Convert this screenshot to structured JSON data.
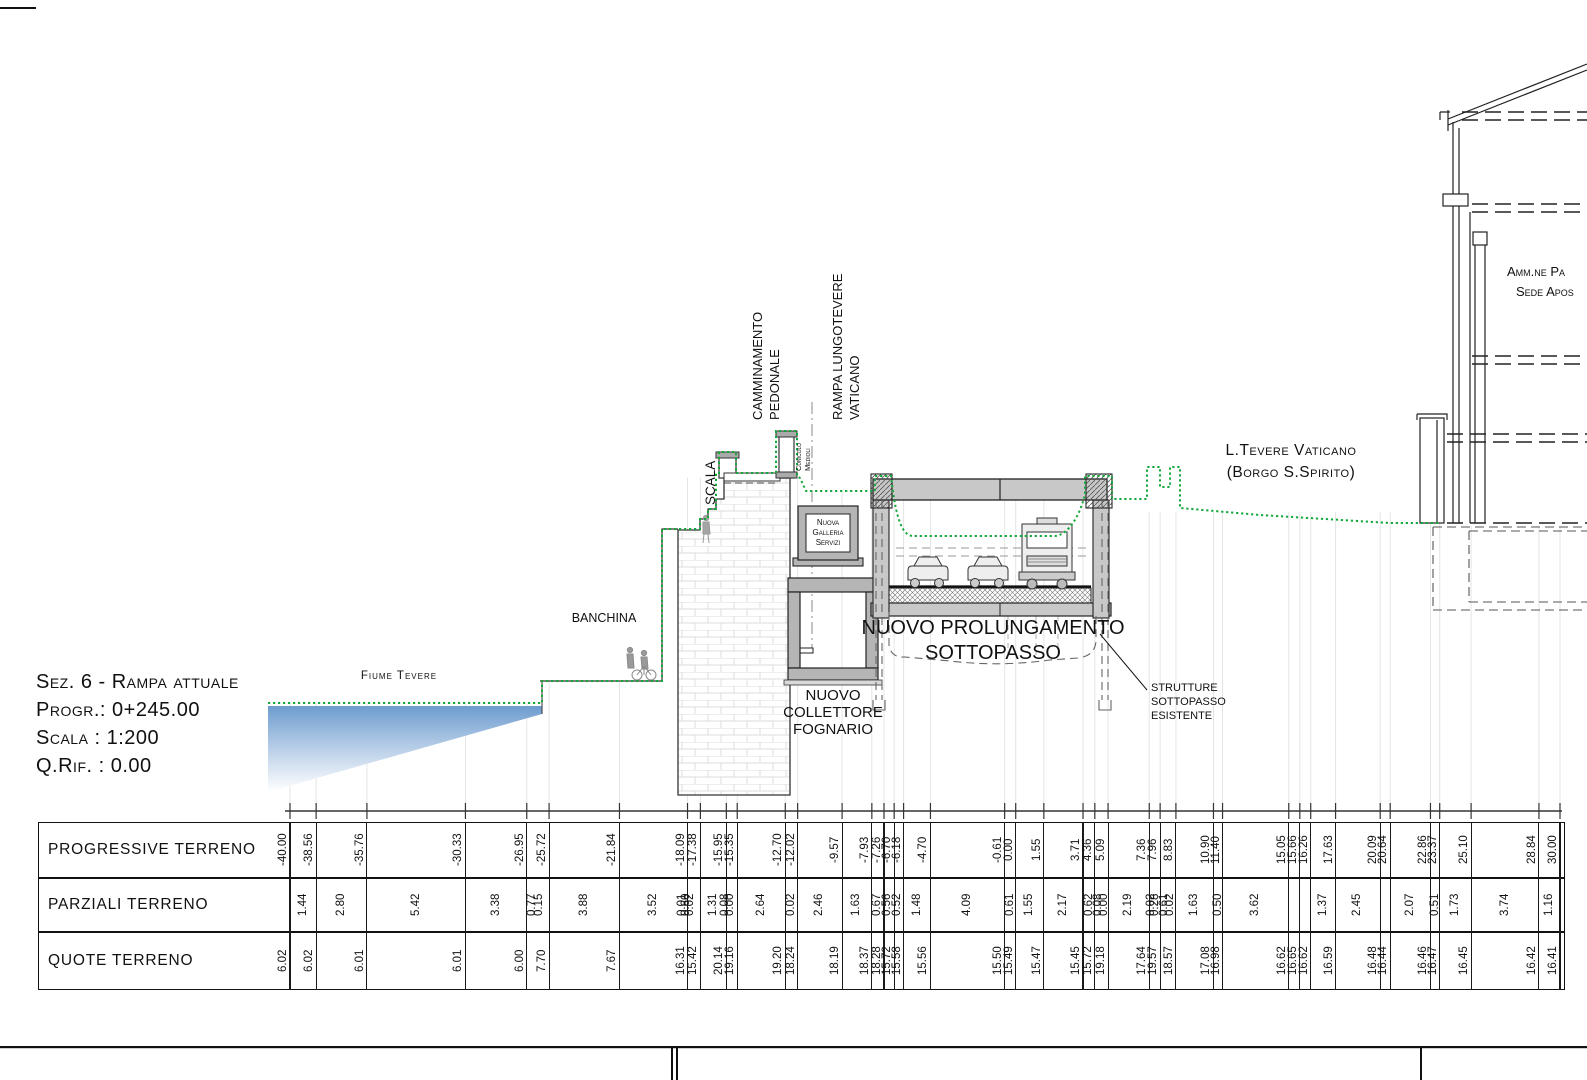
{
  "section_info": {
    "title": "Sez. 6 - Rampa attuale",
    "progressiva": "Progr.: 0+245.00",
    "scala": "Scala : 1:200",
    "q_rif": "Q.Rif. : 0.00"
  },
  "drawing_labels": {
    "fiume_tevere": "Fiume Tevere",
    "banchina": "BANCHINA",
    "scala": "SCALA",
    "camminamento_1": "CAMMINAMENTO",
    "camminamento_2": "PEDONALE",
    "rampa_1": "RAMPA LUNGOTEVERE",
    "rampa_2": "VATICANO",
    "cunicolo_1": "Cunicolo",
    "cunicolo_2": "Medioli",
    "galleria_1": "Nuova",
    "galleria_2": "Galleria",
    "galleria_3": "Servizi",
    "collettore_1": "NUOVO",
    "collettore_2": "COLLETTORE",
    "collettore_3": "FOGNARIO",
    "prolungamento_1": "NUOVO PROLUNGAMENTO",
    "prolungamento_2": "SOTTOPASSO",
    "strutture_1": "STRUTTURE",
    "strutture_2": "SOTTOPASSO",
    "strutture_3": "ESISTENTE",
    "lungotevere_1": "L.Tevere Vaticano",
    "lungotevere_2": "(Borgo S.Spirito)",
    "edificio_1": "Amm.ne Pa",
    "edificio_2": "Sede Apos"
  },
  "colors": {
    "terrain_green": "#14a83b",
    "water_blue": "#6d9ccf",
    "concrete_gray": "#b5b5b5"
  },
  "table": {
    "row_labels": [
      "PROGRESSIVE TERRENO",
      "PARZIALI TERRENO",
      "QUOTE TERRENO"
    ],
    "stations": [
      {
        "v": -40.0,
        "progressive": "-40.00",
        "quote": "6.02"
      },
      {
        "v": -38.56,
        "progressive": "-38.56",
        "quote": "6.02"
      },
      {
        "v": -35.76,
        "progressive": "-35.76",
        "quote": "6.01"
      },
      {
        "v": -30.33,
        "progressive": "-30.33",
        "quote": "6.01"
      },
      {
        "v": -26.95,
        "progressive": "-26.95",
        "quote": "6.00"
      },
      {
        "v": -25.72,
        "progressive": "-25.72",
        "quote": "7.70"
      },
      {
        "v": -21.84,
        "progressive": "-21.84",
        "quote": "7.67"
      },
      {
        "v": -18.09,
        "progressive": "-18.09",
        "quote": "16.31"
      },
      {
        "v": -17.38,
        "progressive": "-17.38",
        "quote": "15.42"
      },
      {
        "v": -15.95,
        "progressive": "-15.95",
        "quote": "20.14"
      },
      {
        "v": -15.35,
        "progressive": "-15.35",
        "quote": "19.16"
      },
      {
        "v": -12.7,
        "progressive": "-12.70",
        "quote": "19.20"
      },
      {
        "v": -12.02,
        "progressive": "-12.02",
        "quote": "18.24"
      },
      {
        "v": -9.57,
        "progressive": "-9.57",
        "quote": "18.19"
      },
      {
        "v": -7.93,
        "progressive": "-7.93",
        "quote": "18.37"
      },
      {
        "v": -7.26,
        "progressive": "-7.26",
        "quote": "18.28"
      },
      {
        "v": -6.7,
        "progressive": "-6.70",
        "quote": "15.72"
      },
      {
        "v": -6.18,
        "progressive": "-6.18",
        "quote": "15.58"
      },
      {
        "v": -4.7,
        "progressive": "-4.70",
        "quote": "15.56"
      },
      {
        "v": -0.61,
        "progressive": "-0.61",
        "quote": "15.50"
      },
      {
        "v": 0.0,
        "progressive": "0.00",
        "quote": "15.49"
      },
      {
        "v": 1.55,
        "progressive": "1.55",
        "quote": "15.47"
      },
      {
        "v": 3.71,
        "progressive": "3.71",
        "quote": "15.45"
      },
      {
        "v": 4.36,
        "progressive": "4.36",
        "quote": "15.72"
      },
      {
        "v": 5.09,
        "progressive": "5.09",
        "quote": "19.18"
      },
      {
        "v": 7.36,
        "progressive": "7.36",
        "quote": "17.64"
      },
      {
        "v": 7.96,
        "progressive": "7.96",
        "quote": "19.57"
      },
      {
        "v": 8.83,
        "progressive": "8.83",
        "quote": "18.57"
      },
      {
        "v": 10.9,
        "progressive": "10.90",
        "quote": "17.08"
      },
      {
        "v": 11.4,
        "progressive": "11.40",
        "quote": "16.98"
      },
      {
        "v": 15.05,
        "progressive": "15.05",
        "quote": "16.62"
      },
      {
        "v": 15.66,
        "progressive": "15.66",
        "quote": "16.65"
      },
      {
        "v": 16.26,
        "progressive": "16.26",
        "quote": "16.62"
      },
      {
        "v": 17.63,
        "progressive": "17.63",
        "quote": "16.59"
      },
      {
        "v": 20.09,
        "progressive": "20.09",
        "quote": "16.48"
      },
      {
        "v": 20.64,
        "progressive": "20.64",
        "quote": "16.44"
      },
      {
        "v": 22.86,
        "progressive": "22.86",
        "quote": "16.46"
      },
      {
        "v": 23.37,
        "progressive": "23.37",
        "quote": "16.47"
      },
      {
        "v": 25.1,
        "progressive": "25.10",
        "quote": "16.45"
      },
      {
        "v": 28.84,
        "progressive": "28.84",
        "quote": "16.42"
      },
      {
        "v": 30.0,
        "progressive": "30.00",
        "quote": "16.41"
      }
    ],
    "parziali": [
      {
        "value": "1.44",
        "pos": -39.28
      },
      {
        "value": "2.80",
        "pos": -37.16
      },
      {
        "value": "5.42",
        "pos": -33.05
      },
      {
        "value": "3.38",
        "pos": -28.64
      },
      {
        "value": "0.77",
        "pos": -26.62
      },
      {
        "value": "0.15",
        "pos": -26.25
      },
      {
        "value": "3.88",
        "pos": -23.78
      },
      {
        "value": "3.52",
        "pos": -19.97
      },
      {
        "value": "0.01",
        "pos": -18.34
      },
      {
        "value": "0.60",
        "pos": -18.12
      },
      {
        "value": "0.02",
        "pos": -17.9
      },
      {
        "value": "1.31",
        "pos": -16.67
      },
      {
        "value": "0.08",
        "pos": -16.02
      },
      {
        "value": "0.00",
        "pos": -15.7
      },
      {
        "value": "2.64",
        "pos": -14.03
      },
      {
        "value": "0.02",
        "pos": -12.36
      },
      {
        "value": "2.46",
        "pos": -10.8
      },
      {
        "value": "1.63",
        "pos": -8.75
      },
      {
        "value": "0.67",
        "pos": -7.6
      },
      {
        "value": "0.56",
        "pos": -7.08
      },
      {
        "value": "0.52",
        "pos": -6.52
      },
      {
        "value": "1.48",
        "pos": -5.44
      },
      {
        "value": "4.09",
        "pos": -2.66
      },
      {
        "value": "0.61",
        "pos": -0.31
      },
      {
        "value": "1.55",
        "pos": 0.78
      },
      {
        "value": "2.17",
        "pos": 2.63
      },
      {
        "value": "0.62",
        "pos": 4.04
      },
      {
        "value": "0.08",
        "pos": 4.58
      },
      {
        "value": "0.00",
        "pos": 4.88
      },
      {
        "value": "2.19",
        "pos": 6.23
      },
      {
        "value": "0.02",
        "pos": 7.48
      },
      {
        "value": "0.28",
        "pos": 7.7
      },
      {
        "value": "0.61",
        "pos": 8.22
      },
      {
        "value": "0.02",
        "pos": 8.52
      },
      {
        "value": "1.63",
        "pos": 9.87
      },
      {
        "value": "0.50",
        "pos": 11.15
      },
      {
        "value": "3.62",
        "pos": 13.23
      },
      {
        "value": "1.37",
        "pos": 16.95
      },
      {
        "value": "2.45",
        "pos": 18.86
      },
      {
        "value": "2.07",
        "pos": 21.75
      },
      {
        "value": "0.51",
        "pos": 23.12
      },
      {
        "value": "1.73",
        "pos": 24.24
      },
      {
        "value": "3.74",
        "pos": 26.97
      },
      {
        "value": "1.16",
        "pos": 29.42
      }
    ]
  }
}
